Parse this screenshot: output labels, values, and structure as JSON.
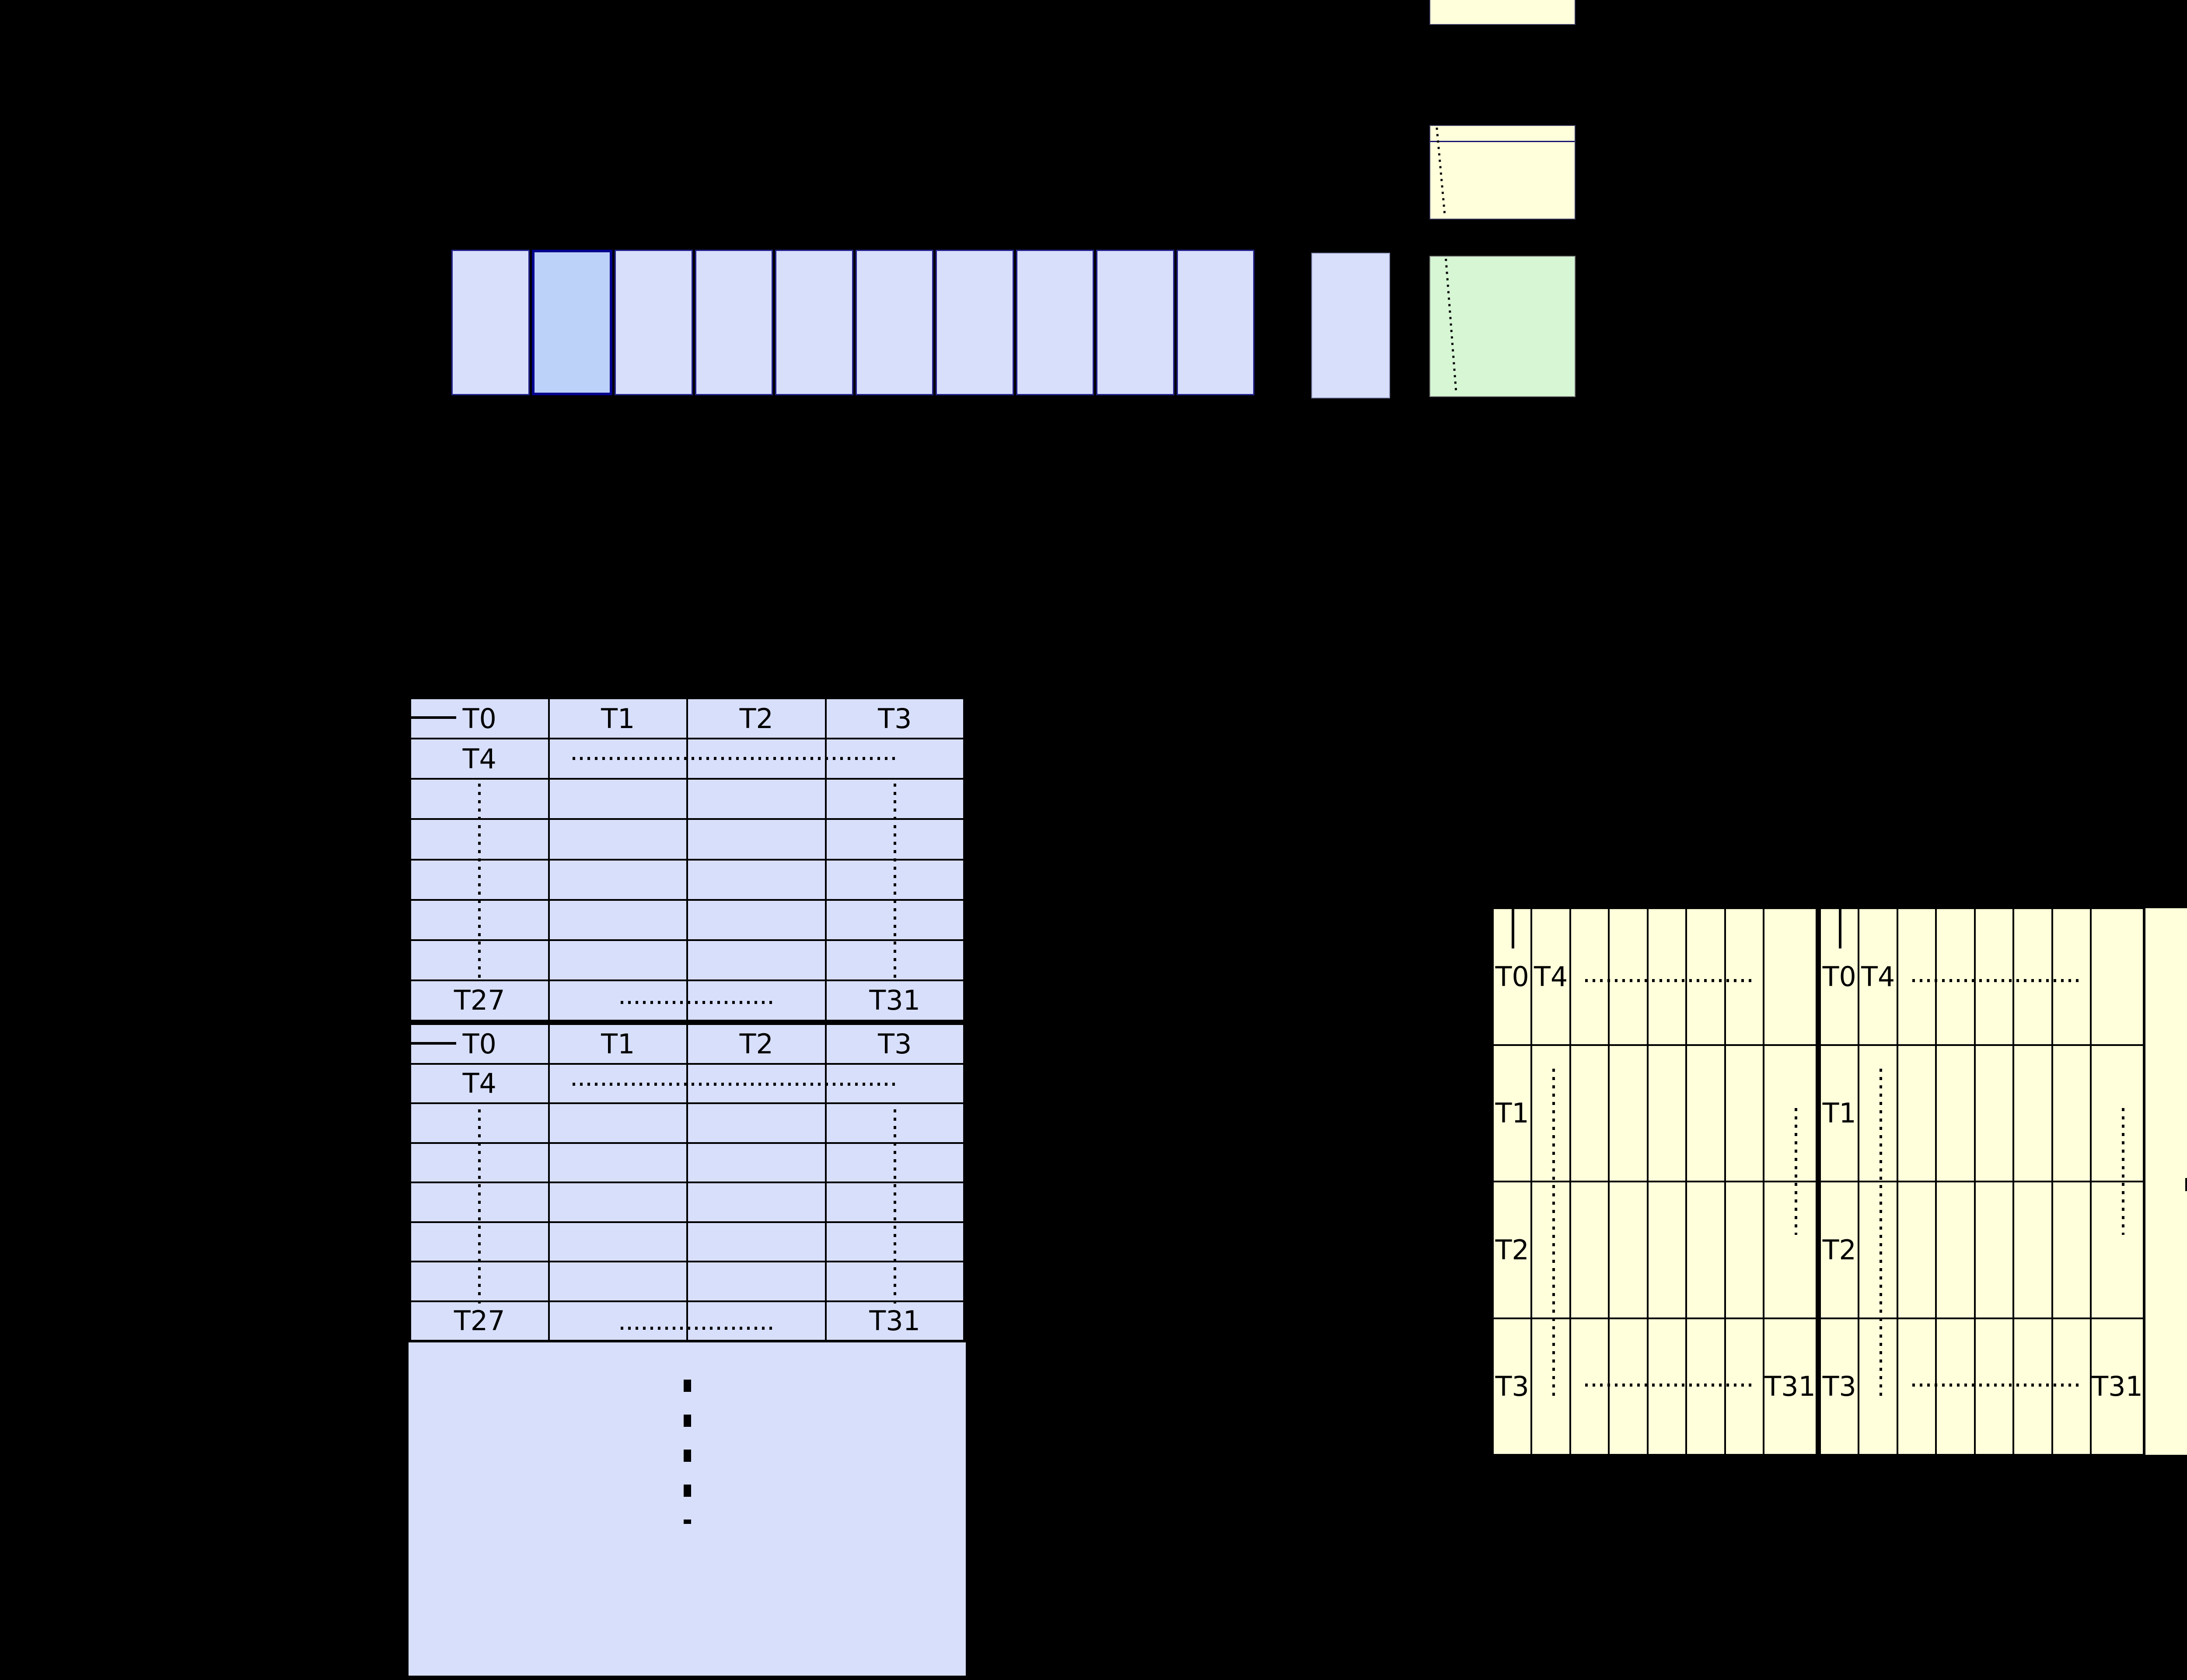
{
  "palette": {
    "background": "#000000",
    "cell_blue": "#d8dffb",
    "highlight_blue": "#bdd2f8",
    "navy_accent": "#00008c",
    "navy_border": "#23238d",
    "pale_yellow": "#ffffdb",
    "pale_green": "#d6f6d4",
    "line_black": "#000000"
  },
  "top_row": {
    "box_count": 10,
    "highlighted_index": 1
  },
  "left_table": {
    "block_count": 2,
    "header": [
      "T0",
      "T1",
      "T2",
      "T3"
    ],
    "row2_first": "T4",
    "last_row_first": "T27",
    "last_row_last": "T31",
    "ellipsis_dot_count": 4
  },
  "right_table": {
    "block_count": 2,
    "row1_labels": [
      "T0",
      "T4"
    ],
    "left_labels": [
      "T1",
      "T2",
      "T3"
    ],
    "bottom_last": "T31",
    "ellipsis_dot_count": 4
  }
}
